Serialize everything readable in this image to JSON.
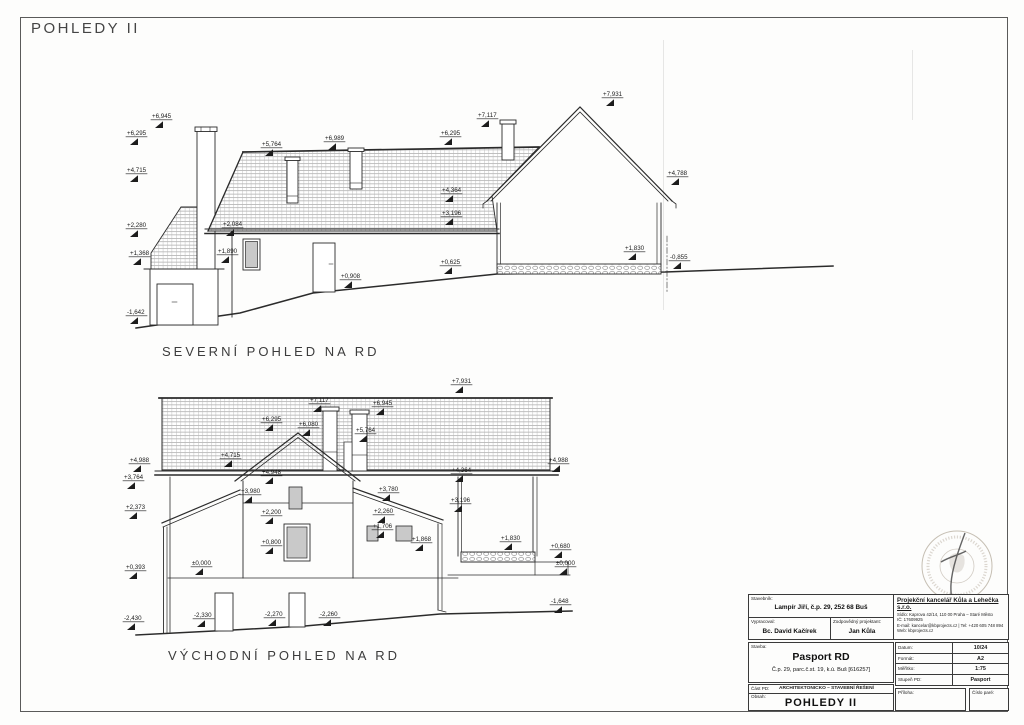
{
  "page": {
    "title": "POHLEDY II"
  },
  "colors": {
    "line": "#2b2b2b",
    "hatch": "#9a9a9a",
    "window_fill": "#c9c9c9",
    "stamp": "#b3a99b"
  },
  "drawings": [
    {
      "id": "north",
      "label": "SEVERNÍ POHLED NA RD",
      "markers": [
        {
          "v": "+6,945",
          "x": 152,
          "y": 118
        },
        {
          "v": "+6,295",
          "x": 127,
          "y": 135
        },
        {
          "v": "+4,715",
          "x": 127,
          "y": 172
        },
        {
          "v": "+2,280",
          "x": 127,
          "y": 227
        },
        {
          "v": "+1,368",
          "x": 130,
          "y": 255
        },
        {
          "v": "-1,642",
          "x": 127,
          "y": 314
        },
        {
          "v": "+5,764",
          "x": 262,
          "y": 146
        },
        {
          "v": "+6,989",
          "x": 325,
          "y": 140
        },
        {
          "v": "+6,295",
          "x": 441,
          "y": 135
        },
        {
          "v": "+7,117",
          "x": 478,
          "y": 117
        },
        {
          "v": "+7,931",
          "x": 603,
          "y": 96
        },
        {
          "v": "+4,364",
          "x": 442,
          "y": 192
        },
        {
          "v": "+3,196",
          "x": 442,
          "y": 215
        },
        {
          "v": "+4,788",
          "x": 668,
          "y": 175
        },
        {
          "v": "+2,084",
          "x": 223,
          "y": 226
        },
        {
          "v": "+1,890",
          "x": 218,
          "y": 253
        },
        {
          "v": "+0,908",
          "x": 341,
          "y": 278
        },
        {
          "v": "+0,625",
          "x": 441,
          "y": 264
        },
        {
          "v": "+1,830",
          "x": 625,
          "y": 250
        },
        {
          "v": "-0,855",
          "x": 670,
          "y": 259
        }
      ]
    },
    {
      "id": "east",
      "label": "VÝCHODNÍ POHLED NA RD",
      "markers": [
        {
          "v": "+7,931",
          "x": 452,
          "y": 383
        },
        {
          "v": "+7,117",
          "x": 310,
          "y": 402
        },
        {
          "v": "+6,945",
          "x": 373,
          "y": 405
        },
        {
          "v": "+6,295",
          "x": 262,
          "y": 421
        },
        {
          "v": "+6,080",
          "x": 299,
          "y": 426
        },
        {
          "v": "+5,764",
          "x": 356,
          "y": 432
        },
        {
          "v": "+4,715",
          "x": 221,
          "y": 457
        },
        {
          "v": "+4,988",
          "x": 130,
          "y": 462
        },
        {
          "v": "+3,764",
          "x": 124,
          "y": 479
        },
        {
          "v": "+4,948",
          "x": 262,
          "y": 474
        },
        {
          "v": "+3,980",
          "x": 241,
          "y": 493
        },
        {
          "v": "+2,200",
          "x": 262,
          "y": 514
        },
        {
          "v": "+0,800",
          "x": 262,
          "y": 544
        },
        {
          "v": "±0,000",
          "x": 192,
          "y": 565
        },
        {
          "v": "+2,373",
          "x": 126,
          "y": 509
        },
        {
          "v": "+0,393",
          "x": 126,
          "y": 569
        },
        {
          "v": "-2,430",
          "x": 124,
          "y": 620
        },
        {
          "v": "-2,330",
          "x": 194,
          "y": 617
        },
        {
          "v": "-2,270",
          "x": 265,
          "y": 616
        },
        {
          "v": "-2,260",
          "x": 320,
          "y": 616
        },
        {
          "v": "+3,780",
          "x": 379,
          "y": 491
        },
        {
          "v": "+2,260",
          "x": 374,
          "y": 513
        },
        {
          "v": "+1,706",
          "x": 373,
          "y": 528
        },
        {
          "v": "+1,868",
          "x": 412,
          "y": 541
        },
        {
          "v": "+4,364",
          "x": 452,
          "y": 472
        },
        {
          "v": "+3,196",
          "x": 451,
          "y": 502
        },
        {
          "v": "+1,830",
          "x": 501,
          "y": 540
        },
        {
          "v": "+0,680",
          "x": 551,
          "y": 548
        },
        {
          "v": "+4,988",
          "x": 549,
          "y": 462
        },
        {
          "v": "±0,000",
          "x": 556,
          "y": 565
        },
        {
          "v": "-1,648",
          "x": 551,
          "y": 603
        }
      ]
    }
  ],
  "titleblock": {
    "stavebnik_label": "Stavebník:",
    "stavebnik": "Lampír Jiří, č.p. 29, 252 68 Buš",
    "company": {
      "name": "Projekční kancelář Kůla a Lehečka s.r.o.",
      "line1": "Sídlo: Kaprova 42/14, 110 00 Praha – Staré Město",
      "line2": "IČ: 17609925",
      "line3": "E-mail: kancelar@kbprojects.cz | Tel: +420 605 748 894",
      "line4": "Web: kbprojects.cz"
    },
    "vypracoval_label": "Vypracoval:",
    "vypracoval": "Bc. David Kačírek",
    "projektant_label": "Zodpovědný projektant:",
    "projektant": "Jan Kůla",
    "stavba_label": "Stavba:",
    "stavba": "Pasport RD",
    "stavba_detail": "Č.p. 29, parc.č.st. 19, k.ú. Buš [616257]",
    "meta": [
      {
        "label": "Datum:",
        "value": "10/24"
      },
      {
        "label": "Formát:",
        "value": "A2"
      },
      {
        "label": "Měřítko:",
        "value": "1:75"
      },
      {
        "label": "Stupeň PD:",
        "value": "Pasport"
      }
    ],
    "cast_pd_label": "Část PD:",
    "cast_pd": "ARCHITEKTONICKO – STAVEBNÍ ŘEŠENÍ",
    "obsah_label": "Obsah:",
    "obsah": "POHLEDY II",
    "priloha_label": "Příloha:",
    "cislo_pare_label": "Číslo paré:"
  }
}
